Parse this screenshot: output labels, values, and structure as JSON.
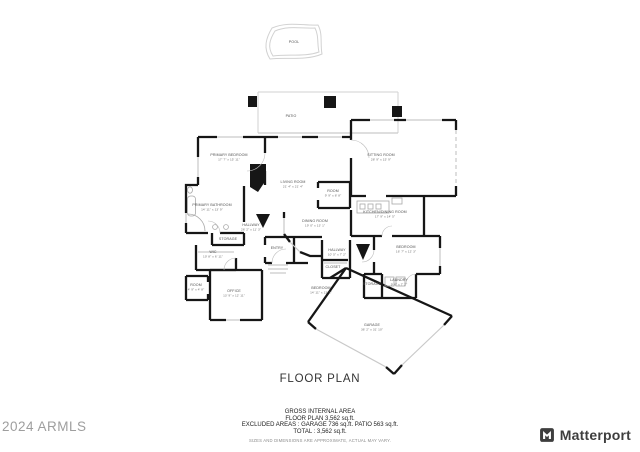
{
  "page_title": "FLOOR PLAN",
  "watermark": "2024 ARMLS",
  "brand": {
    "name": "Matterport",
    "logo_color": "#3e3e3e"
  },
  "area_summary": {
    "line1": "GROSS INTERNAL AREA",
    "line2": "FLOOR PLAN 3,562 sq.ft.",
    "line3": "EXCLUDED AREAS :   GARAGE 736 sq.ft.    PATIO 563 sq.ft.",
    "line4": "TOTAL :  3,562 sq.ft.",
    "disclaimer": "SIZES AND DIMENSIONS ARE APPROXIMATE, ACTUAL MAY VARY."
  },
  "colors": {
    "walls": "#161616",
    "windows": "#c9c9c9",
    "labels": "#4f4f4f",
    "watermark": "#9e9e9e"
  },
  "floor_plan": {
    "rooms": [
      {
        "name": "POOL",
        "dims": "",
        "x": 294,
        "y": 43
      },
      {
        "name": "PATIO",
        "dims": "",
        "x": 291,
        "y": 117
      },
      {
        "name": "PRIMARY BEDROOM",
        "dims": "17' 7\" x 15' 11\"",
        "x": 229,
        "y": 156
      },
      {
        "name": "SITTING ROOM",
        "dims": "28' 9\" x 15' 9\"",
        "x": 381,
        "y": 156
      },
      {
        "name": "LIVING ROOM",
        "dims": "21' 4\" x 21' 4\"",
        "x": 293,
        "y": 183
      },
      {
        "name": "ROOM",
        "dims": "9' 9\" x 8' 8\"",
        "x": 333,
        "y": 192
      },
      {
        "name": "DINING ROOM",
        "dims": "19' 0\" x 13' 1\"",
        "x": 315,
        "y": 222
      },
      {
        "name": "KITCHEN/DINING ROOM",
        "dims": "17' 9\" x 14' 5\"",
        "x": 385,
        "y": 213
      },
      {
        "name": "PRIMARY BATHROOM",
        "dims": "14' 11\" x 13' 9\"",
        "x": 212,
        "y": 206
      },
      {
        "name": "HALLWAY",
        "dims": "26' 2\" x 11' 3\"",
        "x": 251,
        "y": 226
      },
      {
        "name": "STORAGE",
        "dims": "",
        "x": 228,
        "y": 240
      },
      {
        "name": "WIC",
        "dims": "10' 8\" x 6' 11\"",
        "x": 213,
        "y": 253
      },
      {
        "name": "ROOM",
        "dims": "4' 9\" x 4' 8\"",
        "x": 196,
        "y": 286
      },
      {
        "name": "OFFICE",
        "dims": "13' 9\" x 12' 11\"",
        "x": 234,
        "y": 292
      },
      {
        "name": "ENTRY",
        "dims": "",
        "x": 277,
        "y": 249
      },
      {
        "name": "HALLWAY",
        "dims": "10' 5\" x 7' 2\"",
        "x": 337,
        "y": 251
      },
      {
        "name": "CLOSET",
        "dims": "",
        "x": 333,
        "y": 268
      },
      {
        "name": "BEDROOM",
        "dims": "14' 11\" x 13' 1\"",
        "x": 321,
        "y": 289
      },
      {
        "name": "BEDROOM",
        "dims": "16' 7\" x 12' 3\"",
        "x": 406,
        "y": 248
      },
      {
        "name": "LAUNDRY",
        "dims": "9' 6\" x 7' 2\"",
        "x": 399,
        "y": 281
      },
      {
        "name": "STORAGE",
        "dims": "",
        "x": 372,
        "y": 285
      },
      {
        "name": "GARAGE",
        "dims": "36' 2\" x 31' 10\"",
        "x": 372,
        "y": 326
      }
    ]
  }
}
